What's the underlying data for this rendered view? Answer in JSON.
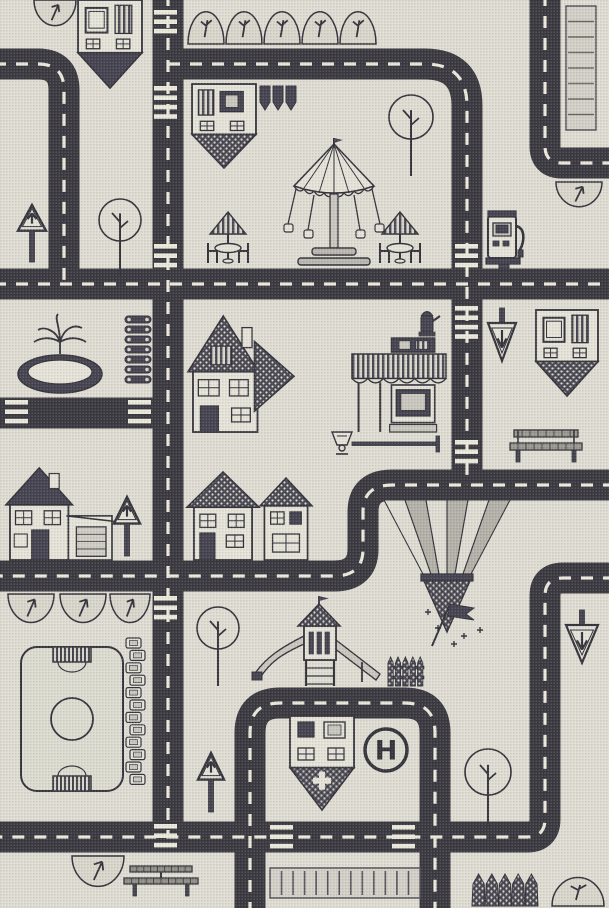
{
  "canvas": {
    "width": 609,
    "height": 908
  },
  "labels": {
    "helipad": "H"
  },
  "colors": {
    "background": "#e0ded3",
    "road": "#3b3940",
    "road_dash": "#ece9dd",
    "ink": "#34323a",
    "dark_fill": "#454350",
    "light_fill": "#e6e4d9",
    "mid_fill": "#c9c7be",
    "bush_fill": "#d9d7cc"
  },
  "roads": [
    {
      "name": "road-top-left-curve",
      "d": "M -6 64 L 38 64 Q 64 64 64 90 L 64 284",
      "dash": true
    },
    {
      "name": "road-main-vertical",
      "d": "M 168 -6 L 168 837",
      "dash": true
    },
    {
      "name": "road-top-horizontal",
      "d": "M 168 64 L 425 64 Q 467 64 467 106 L 467 485",
      "dash": true
    },
    {
      "name": "road-middle-s-curve",
      "d": "M 615 485 L 392 485 Q 363 485 363 512 L 363 549 Q 363 576 334 576 L -6 576",
      "dash": true
    },
    {
      "name": "road-second-horizontal",
      "d": "M -6 284 L 615 284",
      "dash": true
    },
    {
      "name": "road-left-stub",
      "d": "M -6 413 L 168 413",
      "dash": false
    },
    {
      "name": "road-top-right",
      "d": "M 545 -6 L 545 146 Q 545 163 562 163 L 615 163",
      "dash": true
    },
    {
      "name": "road-right-vertical-loop",
      "d": "M 615 578 L 563 578 Q 545 578 545 596 L 545 819 Q 545 837 527 837 L -6 837",
      "dash": true
    },
    {
      "name": "road-bottom-circuit",
      "d": "M 250 914 L 250 733 Q 250 703 280 703 L 405 703 Q 435 703 435 733 L 435 914",
      "dash": true
    }
  ],
  "crosswalks": [
    {
      "x": 154,
      "y": 10,
      "bars": 3
    },
    {
      "x": 154,
      "y": 86,
      "bars": 4
    },
    {
      "x": 154,
      "y": 244,
      "bars": 3
    },
    {
      "x": 455,
      "y": 244,
      "bars": 3
    },
    {
      "x": 455,
      "y": 306,
      "bars": 4
    },
    {
      "x": 455,
      "y": 440,
      "bars": 3
    },
    {
      "x": 154,
      "y": 596,
      "bars": 3
    },
    {
      "x": 154,
      "y": 824,
      "bars": 3
    },
    {
      "x": 270,
      "y": 825,
      "bars": 3
    },
    {
      "x": 392,
      "y": 825,
      "bars": 3
    },
    {
      "x": 5,
      "y": 400,
      "bars": 3
    },
    {
      "x": 128,
      "y": 400,
      "bars": 3
    }
  ],
  "parking": [
    {
      "name": "parking-strip-top-right",
      "x": 566,
      "y": 6,
      "w": 30,
      "h": 124,
      "cells": 8,
      "dir": "h"
    },
    {
      "name": "parking-lot-bottom",
      "x": 270,
      "y": 868,
      "w": 150,
      "h": 30,
      "cells": 12,
      "dir": "v"
    }
  ],
  "features": [
    {
      "type": "bushDown",
      "x": 34,
      "y": 0,
      "w": 42,
      "h": 27
    },
    {
      "type": "shieldHouse",
      "x": 78,
      "y": 0,
      "w": 64,
      "h": 88,
      "tip": "solid",
      "variant": 1
    },
    {
      "type": "bushUp",
      "x": 188,
      "y": 10,
      "w": 36,
      "h": 34
    },
    {
      "type": "bushUp",
      "x": 226,
      "y": 10,
      "w": 36,
      "h": 34
    },
    {
      "type": "bushUp",
      "x": 264,
      "y": 10,
      "w": 36,
      "h": 34
    },
    {
      "type": "bushUp",
      "x": 302,
      "y": 10,
      "w": 36,
      "h": 34
    },
    {
      "type": "bushUp",
      "x": 340,
      "y": 10,
      "w": 36,
      "h": 34
    },
    {
      "type": "shieldHouse",
      "x": 192,
      "y": 84,
      "w": 64,
      "h": 84,
      "tip": "dots",
      "variant": 2
    },
    {
      "type": "pennants",
      "x": 260,
      "y": 86,
      "w": 36,
      "h": 28
    },
    {
      "type": "tree",
      "x": 388,
      "y": 94,
      "r": 23,
      "trunk": 36
    },
    {
      "type": "carousel",
      "x": 284,
      "y": 138,
      "w": 100,
      "h": 130
    },
    {
      "type": "umbrellaTable",
      "x": 202,
      "y": 210,
      "w": 52,
      "h": 56
    },
    {
      "type": "umbrellaTable",
      "x": 374,
      "y": 210,
      "w": 52,
      "h": 56
    },
    {
      "type": "gasPump",
      "x": 486,
      "y": 208,
      "w": 40,
      "h": 62
    },
    {
      "type": "bushDown",
      "x": 556,
      "y": 182,
      "w": 46,
      "h": 26
    },
    {
      "type": "signUp",
      "x": 16,
      "y": 204,
      "w": 32,
      "h": 58
    },
    {
      "type": "tree",
      "x": 98,
      "y": 198,
      "r": 22,
      "trunk": 34
    },
    {
      "type": "fountain",
      "x": 16,
      "y": 312,
      "w": 88,
      "h": 82
    },
    {
      "type": "logs",
      "x": 124,
      "y": 314,
      "w": 28,
      "h": 74
    },
    {
      "type": "bigHouse",
      "x": 190,
      "y": 316,
      "w": 104,
      "h": 116
    },
    {
      "type": "hydrant",
      "x": 416,
      "y": 306,
      "w": 26,
      "h": 32
    },
    {
      "type": "shop",
      "x": 352,
      "y": 338,
      "w": 94,
      "h": 94
    },
    {
      "type": "lampH",
      "x": 330,
      "y": 430,
      "w": 116,
      "h": 30
    },
    {
      "type": "signDown",
      "x": 486,
      "y": 308,
      "w": 32,
      "h": 66
    },
    {
      "type": "shieldHouse",
      "x": 536,
      "y": 310,
      "w": 62,
      "h": 86,
      "tip": "dots",
      "variant": 3
    },
    {
      "type": "bench",
      "x": 510,
      "y": 428,
      "w": 72,
      "h": 36
    },
    {
      "type": "houseGarage",
      "x": 8,
      "y": 468,
      "w": 104,
      "h": 92
    },
    {
      "type": "signUp",
      "x": 112,
      "y": 496,
      "w": 30,
      "h": 60
    },
    {
      "type": "gableHouse",
      "x": 190,
      "y": 472,
      "w": 66,
      "h": 88
    },
    {
      "type": "smallHouse",
      "x": 262,
      "y": 478,
      "w": 48,
      "h": 82
    },
    {
      "type": "fanField",
      "x": 384,
      "y": 500,
      "w": 126,
      "h": 134
    },
    {
      "type": "flagSparkles",
      "x": 424,
      "y": 596,
      "w": 62,
      "h": 54
    },
    {
      "type": "signDown",
      "x": 564,
      "y": 610,
      "w": 36,
      "h": 66
    },
    {
      "type": "bushDown",
      "x": 8,
      "y": 594,
      "w": 46,
      "h": 30
    },
    {
      "type": "bushDown",
      "x": 60,
      "y": 594,
      "w": 46,
      "h": 30
    },
    {
      "type": "bushDown",
      "x": 110,
      "y": 594,
      "w": 40,
      "h": 30
    },
    {
      "type": "soccer",
      "x": 20,
      "y": 646,
      "w": 104,
      "h": 146
    },
    {
      "type": "bleachers",
      "x": 126,
      "y": 638,
      "w": 24,
      "h": 148
    },
    {
      "type": "tree",
      "x": 196,
      "y": 606,
      "r": 22,
      "trunk": 36
    },
    {
      "type": "signUp",
      "x": 196,
      "y": 752,
      "w": 30,
      "h": 60
    },
    {
      "type": "playground",
      "x": 250,
      "y": 596,
      "w": 134,
      "h": 92
    },
    {
      "type": "fence",
      "x": 388,
      "y": 652,
      "w": 36,
      "h": 34
    },
    {
      "type": "hospital",
      "x": 290,
      "y": 716,
      "w": 64,
      "h": 94
    },
    {
      "type": "helipad",
      "x": 362,
      "y": 726,
      "w": 48,
      "h": 48
    },
    {
      "type": "tree",
      "x": 464,
      "y": 748,
      "r": 24,
      "trunk": 30
    },
    {
      "type": "bushDown",
      "x": 72,
      "y": 856,
      "w": 52,
      "h": 32
    },
    {
      "type": "picnicTable",
      "x": 124,
      "y": 860,
      "w": 74,
      "h": 38
    },
    {
      "type": "hedge",
      "x": 472,
      "y": 872,
      "w": 66,
      "h": 34
    },
    {
      "type": "bushUp",
      "x": 552,
      "y": 876,
      "w": 52,
      "h": 30
    }
  ]
}
